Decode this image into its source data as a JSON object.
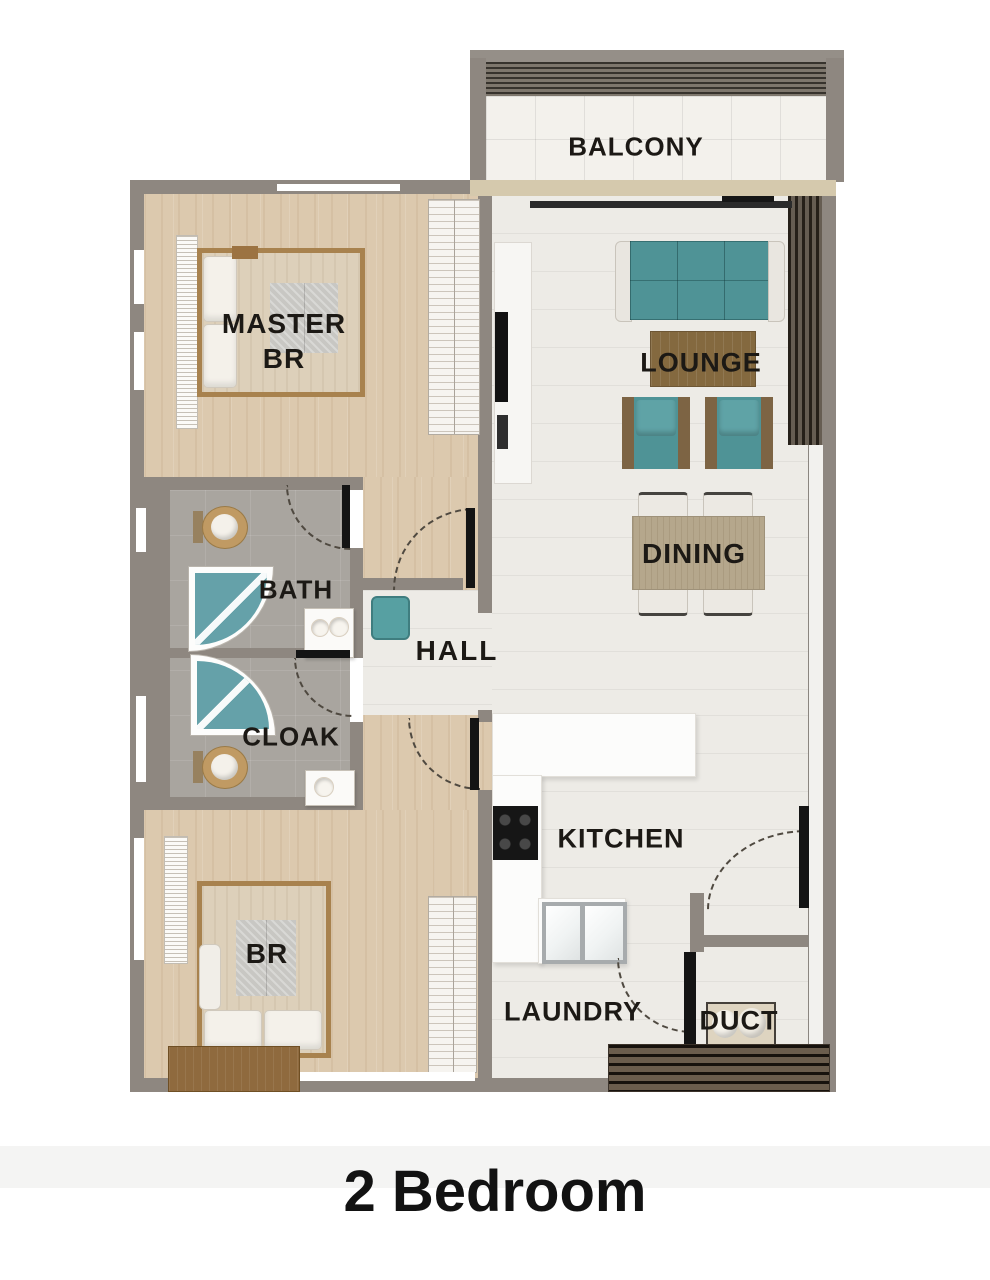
{
  "title": "2 Bedroom",
  "rooms": {
    "balcony": {
      "label": "BALCONY"
    },
    "master_bedroom": {
      "label_line1": "MASTER",
      "label_line2": "BR"
    },
    "lounge": {
      "label": "LOUNGE"
    },
    "dining": {
      "label": "DINING"
    },
    "bath": {
      "label": "BATH"
    },
    "hall": {
      "label": "HALL"
    },
    "cloak": {
      "label": "CLOAK"
    },
    "kitchen": {
      "label": "KITCHEN"
    },
    "bedroom": {
      "label": "BR"
    },
    "laundry": {
      "label": "LAUNDRY"
    },
    "duct": {
      "label": "DUCT"
    }
  },
  "colors": {
    "wall": "#8e8780",
    "wood_floor": "#dcc9ae",
    "tile_floor": "#edebe6",
    "bath_floor": "#a9a59f",
    "balcony_floor": "#f3f1ec",
    "teal_furniture": "#4f9396",
    "wood_furniture": "#8a6f4b",
    "door_leaf": "#141414",
    "label_text": "#1c1915"
  }
}
